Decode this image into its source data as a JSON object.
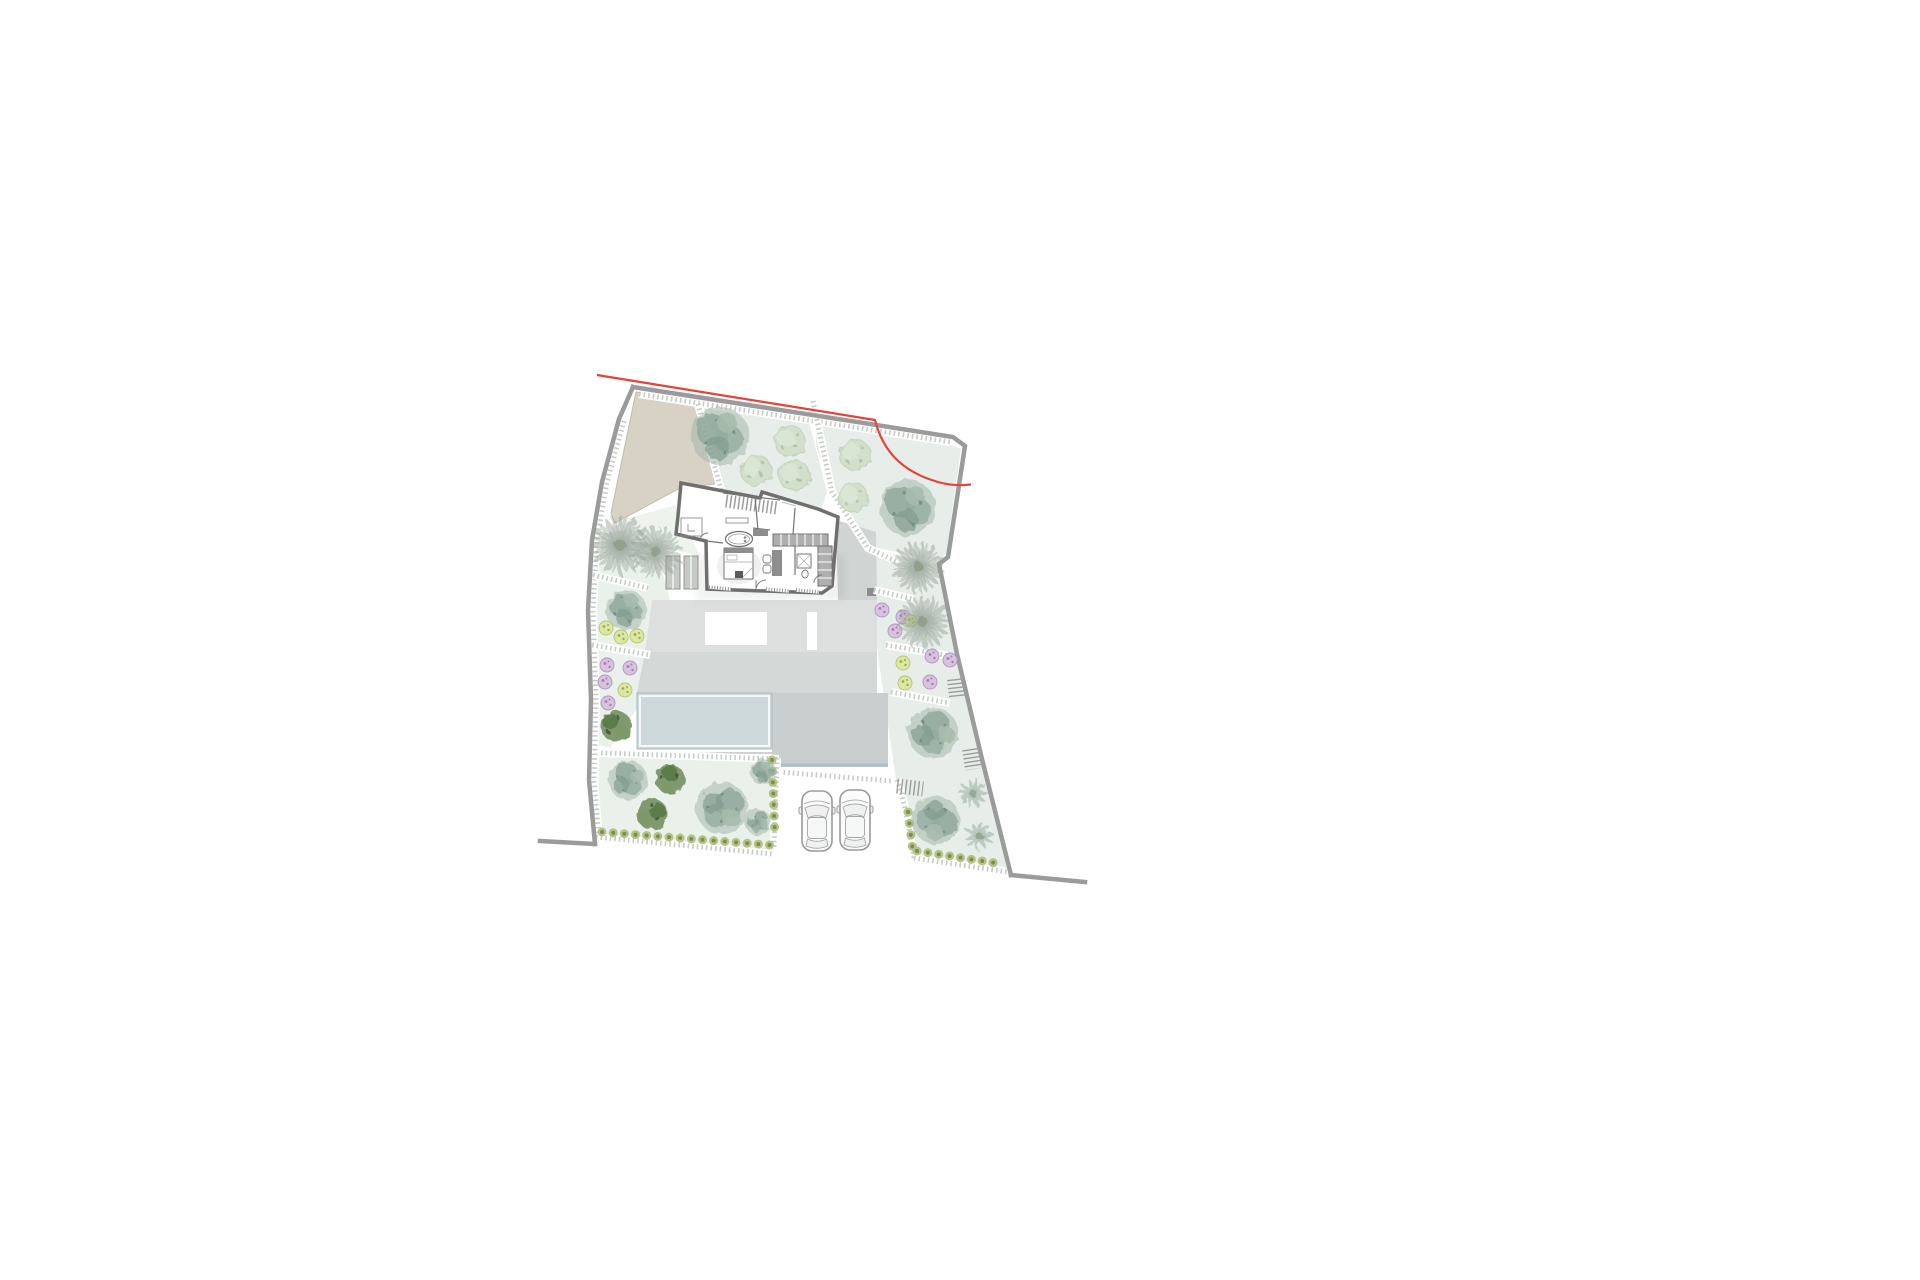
{
  "page": {
    "background": "#ffffff",
    "description": "Architectural site plan of a villa plot with garden, pool terrace, parking and trees",
    "title": "Villa site plan"
  },
  "colors": {
    "boundary": "#9b9b9b",
    "red_line": "#e6423a",
    "beige_drive": "#d8d2c5",
    "garden": "#e7ede8",
    "garden_light": "#eaf0ea",
    "terrace_upper": "#dcdfde",
    "terrace_mid": "#d4d8d7",
    "terrace_dark": "#c9cfce",
    "terrace_east": "#d0d4d3",
    "pool_water": "#cdd8db",
    "pool_edge_blue": "#a9bfca",
    "wall_dark": "#6f6f6f",
    "furniture_gray": "#8d8d8d",
    "closet_gray": "#b0b0b0",
    "path_dot": "#c6ccc6",
    "tree_olive": "#9db4a7",
    "tree_olive_dark": "#7e9a8b",
    "tree_pale": "#ccdcc6",
    "tree_dark": "#6d8a59",
    "palm": "#93a295",
    "bush_yellow": "#dce79f",
    "bush_purple": "#d8c3df",
    "hedge": "#b5c283",
    "hedge_dark": "#7d8c51",
    "car_body": "#fbfbfb",
    "car_line": "#9a9a9a",
    "planter_gray": "#c6cac6"
  },
  "plan": {
    "kind": "architectural-site-plan",
    "features": [
      "plot-boundary",
      "red-setback-line",
      "driveway-strip",
      "upper-garden",
      "east-garden",
      "left-garden-strip",
      "lower-left-garden",
      "lower-right-garden",
      "villa-floor-plan",
      "interior-staircase",
      "bathtub",
      "bed",
      "wardrobes",
      "shower",
      "bathroom-sinks",
      "terrace",
      "pool",
      "pool-deck",
      "parking-area",
      "garden-paths",
      "hedge-rows",
      "palm-trees",
      "olive-trees",
      "pale-trees",
      "dark-shrubs",
      "flowering-shrubs",
      "garden-stairs"
    ],
    "counts": {
      "cars": 2,
      "palm_trees": 4,
      "frond_trees": 2,
      "olive_trees": 7,
      "pale_trees": 5,
      "dark_shrub_trees": 3,
      "garden_stair_flights": 3,
      "pools": 1,
      "hedge_rows": 4
    }
  }
}
